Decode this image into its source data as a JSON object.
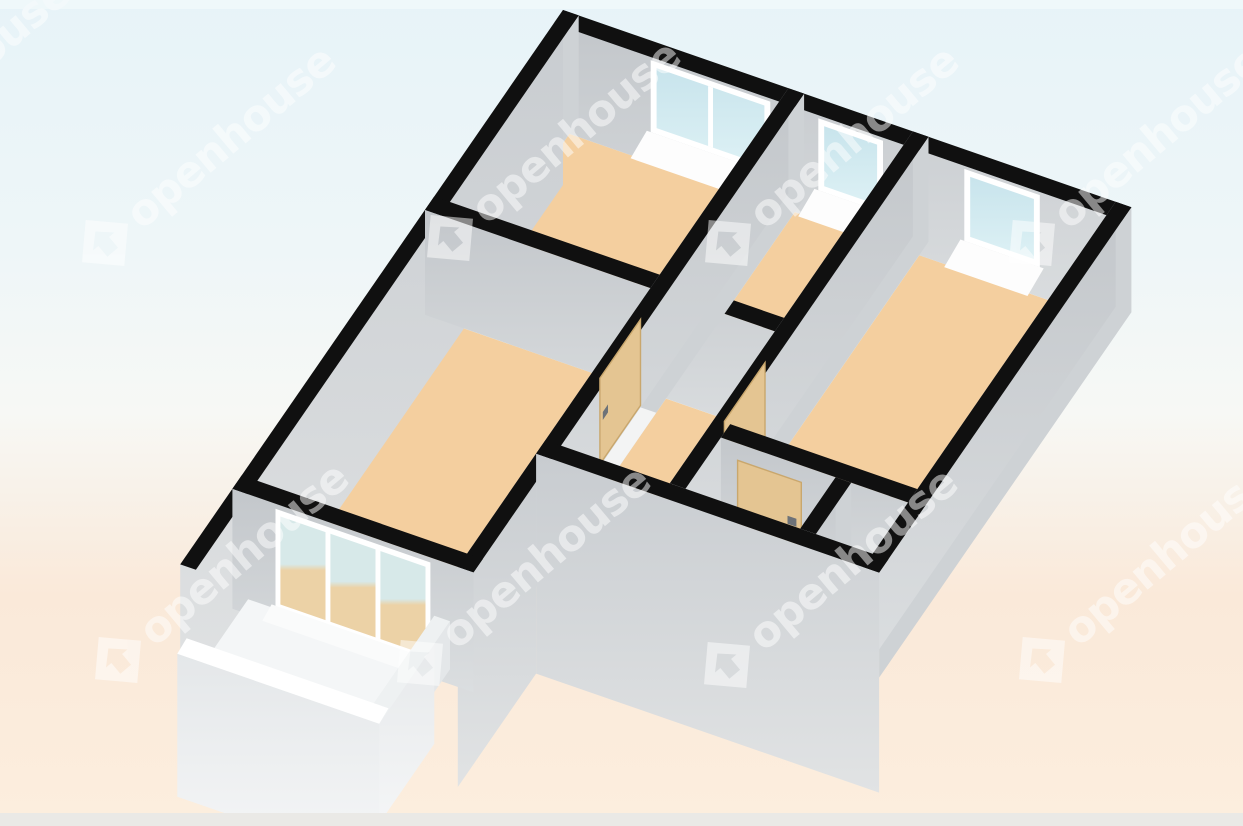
{
  "image": {
    "kind": "3d-floor-plan-render",
    "width_px": 1243,
    "height_px": 826
  },
  "watermark": {
    "text": "openhouse",
    "logo": "house-in-diamond-icon",
    "color": "#ffffff",
    "opacity": 0.5,
    "angle_deg": -40,
    "instances": 9
  },
  "palette": {
    "bg_top": "#e7f3f8",
    "bg_upper": "#eef6f8",
    "bg_mid": "#f7f8f5",
    "bg_lower": "#fae9d9",
    "bg_bottom": "#fceede",
    "edge_strip_bottom": "#eae9e6",
    "edge_strip_top": "#f2f9fb",
    "wall_top_black": "#101010",
    "wall_face_dark": "#c3c7cb",
    "wall_face_light": "#dbdee0",
    "wall_far_face": "#ced2d5",
    "exterior_face_dark": "#c8ccd0",
    "exterior_face_light": "#e1e3e4",
    "floor_orange": "#f4cf9f",
    "bath_floor": "#dcdee0",
    "nook_floor": "#d3d6d9",
    "door_mat": "#efc893",
    "balcony_floor": "#f4f6f7",
    "parapet_top": "#eef1f2",
    "parapet_face_light": "#f6f7f8",
    "parapet_face_dark": "#e4e7e9",
    "window_glass_top": "#c8e4ec",
    "window_glass_bottom": "#ddf1f5",
    "window_frame": "#ffffff",
    "door_tan": "#e4c592",
    "door_edge": "#c9a76d",
    "door_handle": "#6d7278",
    "radiator_base": "#eef0f1",
    "radiator_stripe": "#b4b8bb",
    "glassdoor_upper": "#d7e9e9",
    "glassdoor_lower": "#ecd2a6"
  },
  "scene": {
    "description": "Axonometric 3D floor plan of an apartment, viewed from above at an angle",
    "rooms": [
      {
        "name": "bedroom-top-left",
        "floor": "orange",
        "window": "double"
      },
      {
        "name": "small-room-middle",
        "floor": "orange",
        "window": "single"
      },
      {
        "name": "bedroom-right",
        "floor": "orange",
        "window": "single"
      },
      {
        "name": "living-room",
        "floor": "orange",
        "window": "balcony-glass-doors"
      },
      {
        "name": "hallway",
        "floor": "orange"
      },
      {
        "name": "bathroom",
        "floor": "gray",
        "features": [
          "radiator",
          "door-mat"
        ]
      },
      {
        "name": "storage-nook",
        "floor": "gray"
      },
      {
        "name": "balcony",
        "floor": "white",
        "features": [
          "railing-parapet"
        ]
      }
    ],
    "doors_count": 3,
    "window_openings_count": 3,
    "walls": "black top edges with gray faces"
  }
}
